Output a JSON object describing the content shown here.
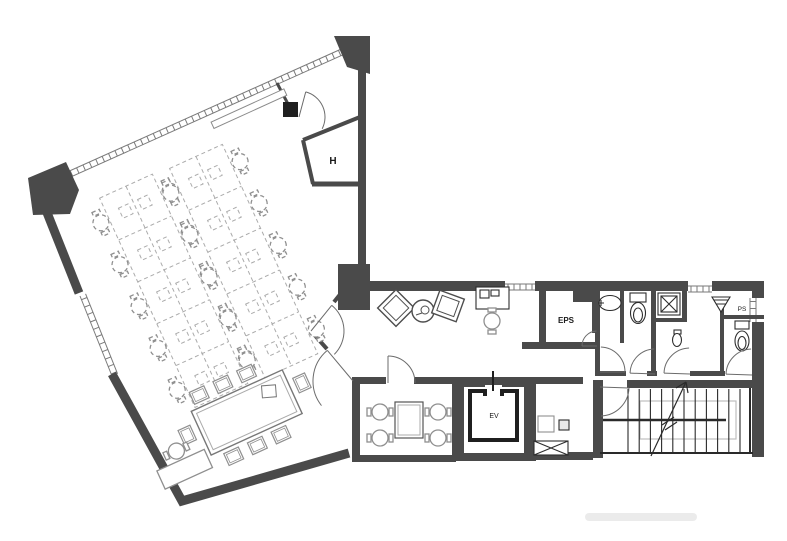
{
  "page": {
    "title": "Office floor plan"
  },
  "colors": {
    "wall": "#4a4a4a",
    "black": "#1f1f1f",
    "furniture": "#8f8f8f",
    "light_line": "#ababab",
    "dash": "#666666",
    "background": "#ffffff"
  },
  "labels": {
    "electrical_pipe_shaft": "EPS",
    "elevator": "EV",
    "hoist_shaft": "H",
    "pipe_shaft": "PS"
  },
  "office": {
    "workstation_benches": 2,
    "desk_rows_per_bench": 5,
    "desks_per_bench": 10,
    "total_workstations": 20,
    "meeting_table_seats": 8,
    "corner_desk_seats": 1
  },
  "entrance": {
    "lounge_chairs": 2,
    "round_tables": 1,
    "reception_desks": 1,
    "reception_seats": 1
  },
  "small_meeting_room": {
    "seats": 4
  },
  "facilities": {
    "toilets": 2,
    "urinals": 1,
    "washbasins": 1,
    "elevators": 1,
    "stairs": 1
  }
}
